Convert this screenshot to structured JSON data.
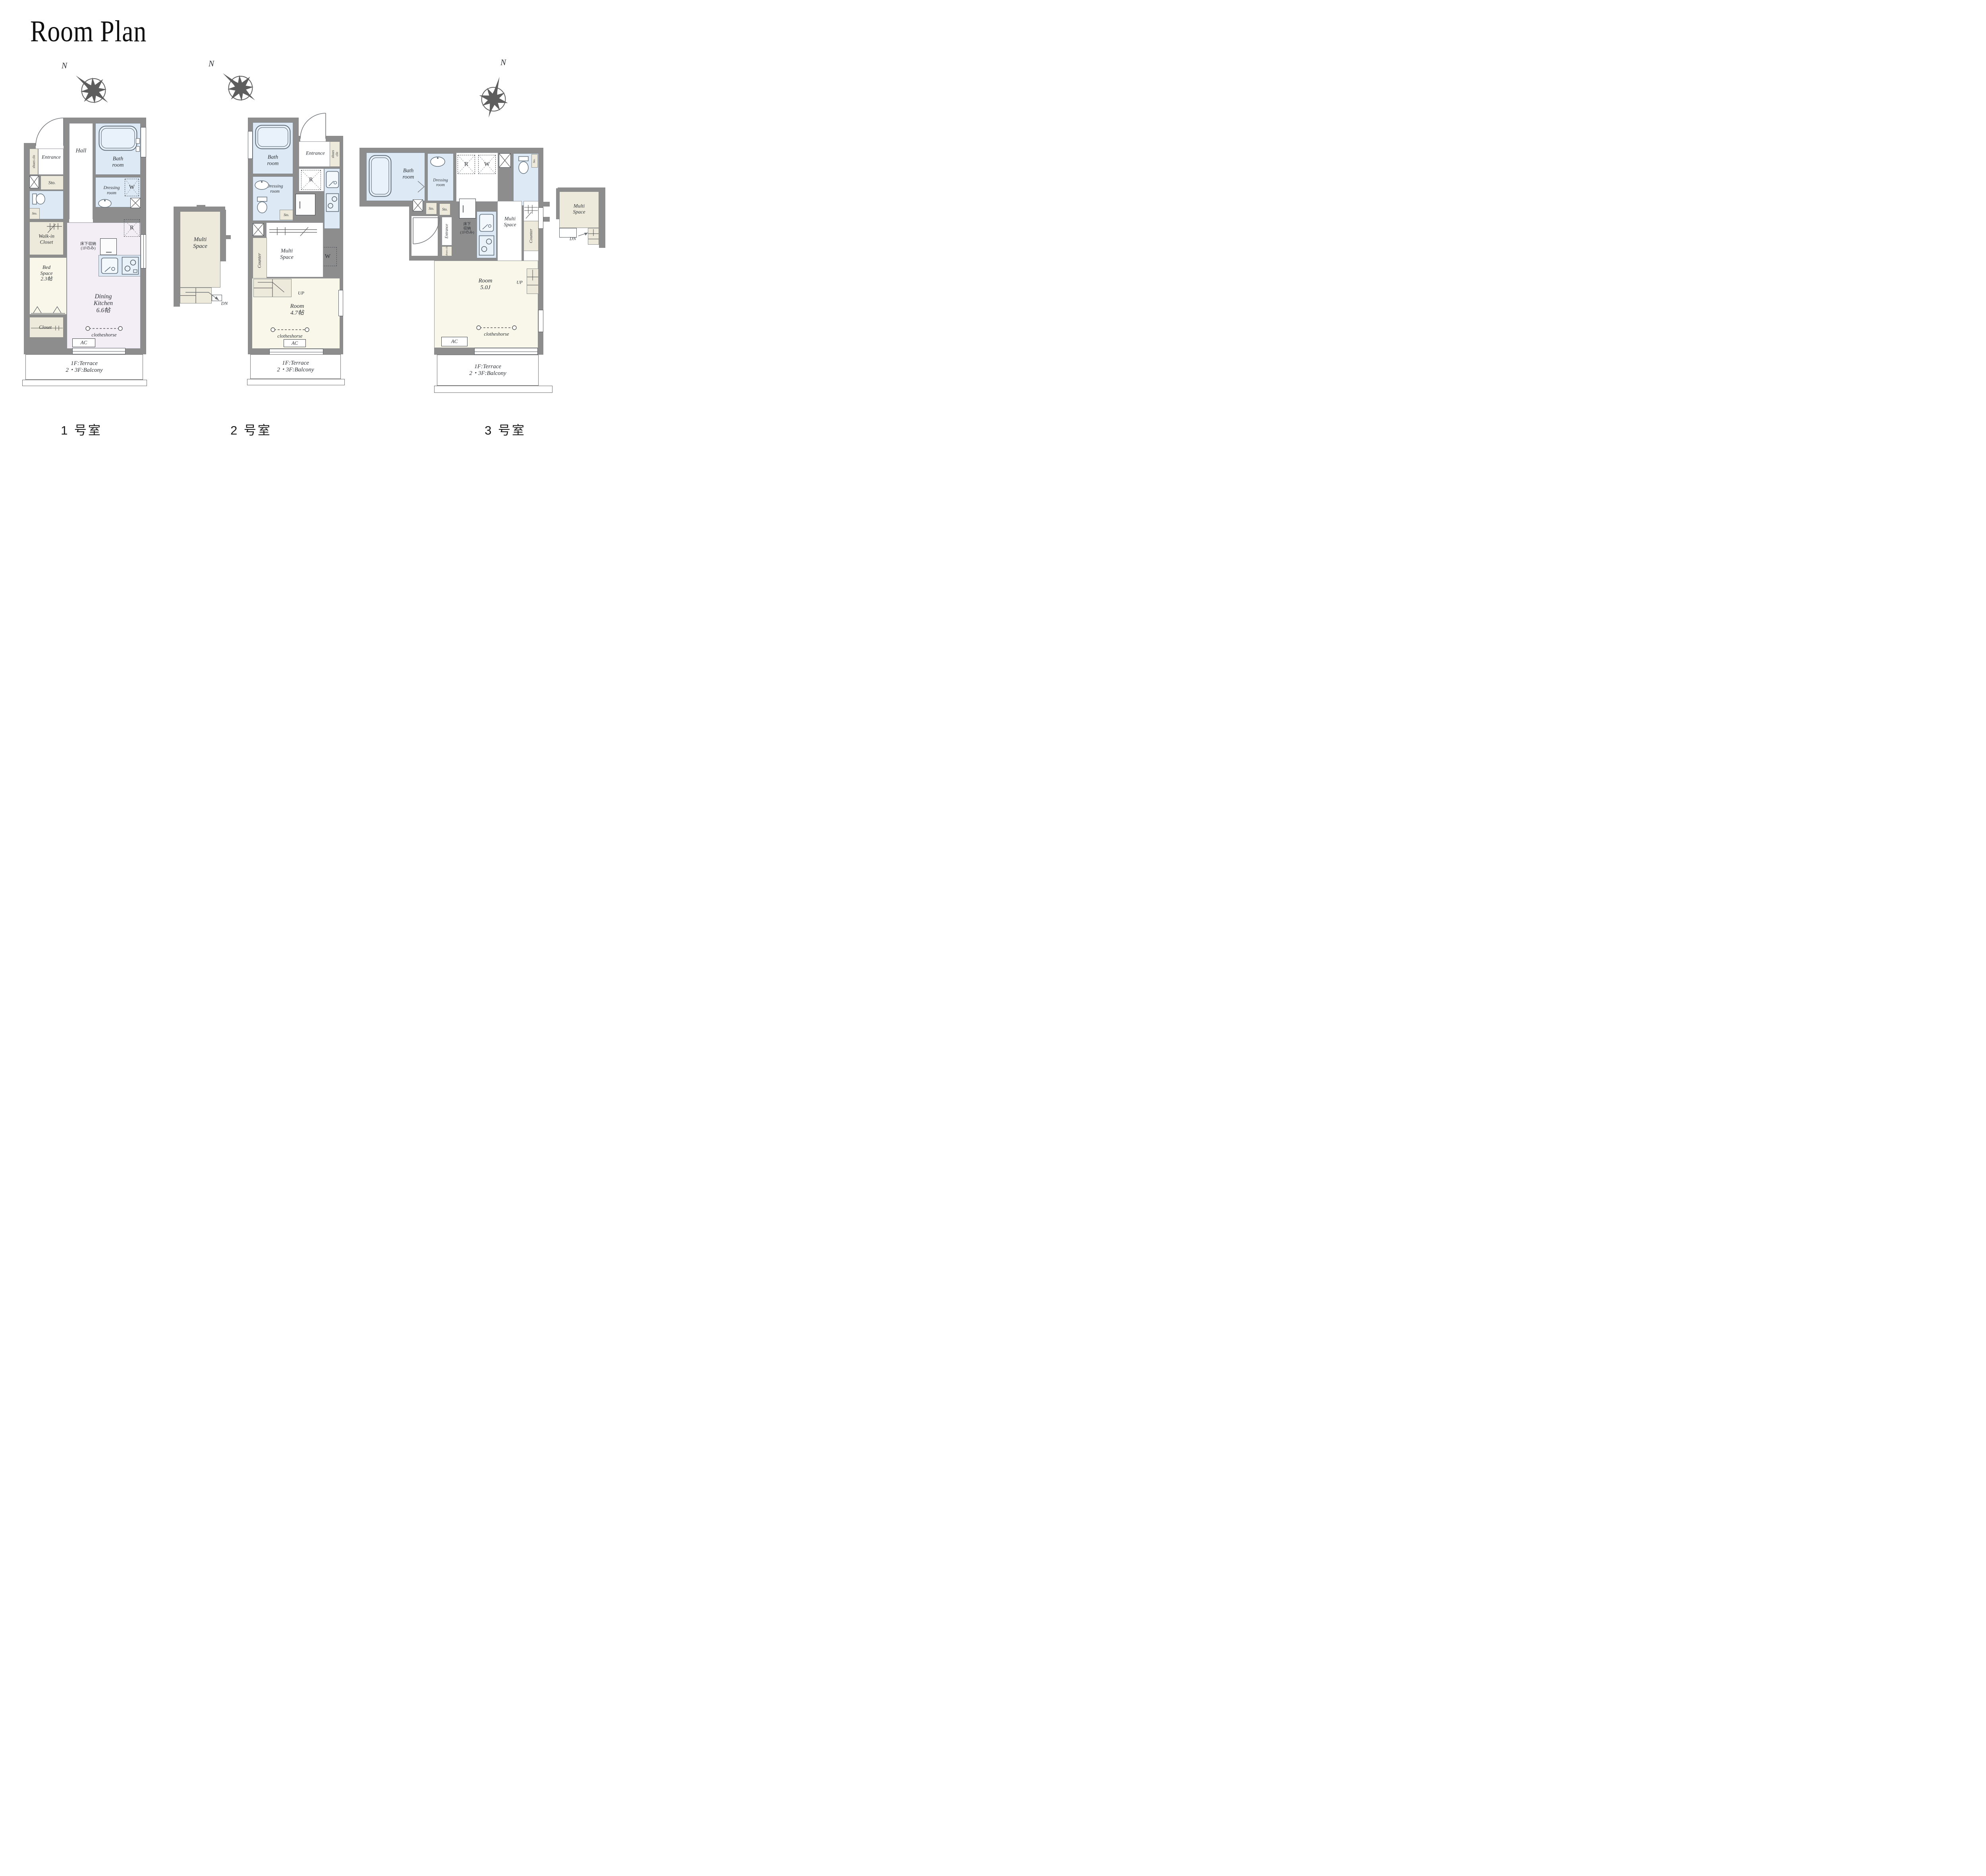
{
  "title": "Room Plan",
  "compass": {
    "letter": "N"
  },
  "colors": {
    "wall": "#8d8d8d",
    "water_blue": "#dde9f5",
    "storage_tan": "#edeadb",
    "room_cream": "#f8f7ea",
    "dk_lavender": "#f3eef5",
    "line_dark": "#555b60"
  },
  "footer": {
    "unit1": "1 号室",
    "unit2": "2 号室",
    "unit3": "3 号室"
  },
  "plan1": {
    "shoes_clo": "shoes clo",
    "entrance": "Entrance",
    "sto": "Sto.",
    "hall": "Hall",
    "bath": "Bath\nroom",
    "dressing": "Dressing\nroom",
    "w": "W",
    "r": "R",
    "toilet_sto": "Sto.",
    "walkin": "Walk-in\nCloset",
    "underfloor": "床下収納\n(1Fのみ)",
    "bed": "Bed\nSpace\n2.3帖",
    "rollscreen": "Rollscreen",
    "dk": "Dining\nKitchen\n6.6帖",
    "closet": "Closet",
    "clotheshorse": "clotheshorse",
    "ac": "AC",
    "terrace": "1F:Terrace\n2・3F:Balcony",
    "multi": {
      "label": "Multi\nSpace",
      "dn": "DN"
    }
  },
  "plan2": {
    "bath": "Bath\nroom",
    "entrance": "Entrance",
    "shoes_clo": "shoes clo",
    "r": "R",
    "dressing": "Dressing\nroom",
    "sto": "Sto.",
    "underfloor": "床下\n収納\n(1Fのみ)",
    "w": "W",
    "multi": "Multi\nSpace",
    "counter": "Counter",
    "up": "UP",
    "room": "Room\n4.7帖",
    "clotheshorse": "clotheshorse",
    "ac": "AC",
    "terrace": "1F:Terrace\n2・3F:Balcony"
  },
  "plan3": {
    "bath": "Bath\nroom",
    "dressing": "Dressing\nroom",
    "r": "R",
    "w": "W",
    "sto_a": "Sto.",
    "sto_b": "Sto.",
    "sto_c": "Sto.",
    "entrance": "Entrance",
    "shoes_clo": "shoes clo",
    "underfloor": "床下\n収納\n(1Fのみ)",
    "multi": "Multi\nSpace",
    "counter": "Counter",
    "up": "UP",
    "room": "Room\n5.0J",
    "ac": "AC",
    "clotheshorse": "clotheshorse",
    "terrace": "1F:Terrace\n2・3F:Balcony",
    "multi2": {
      "label": "Multi\nSpace",
      "dn": "DN"
    }
  }
}
